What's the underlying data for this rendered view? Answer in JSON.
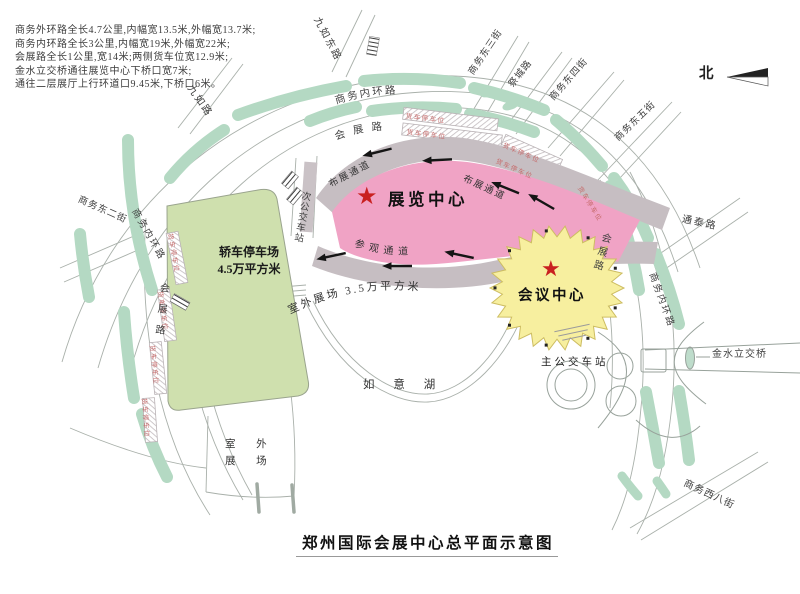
{
  "title": "郑州国际会展中心总平面示意图",
  "legend": {
    "lines": [
      "商务外环路全长4.7公里,内幅宽13.5米,外幅宽13.7米;",
      "商务内环路全长3公里,内幅宽19米,外幅宽22米;",
      "会展路全长1公里,宽14米;两侧货车位宽12.9米;",
      "金水立交桥通往展览中心下桥口宽7米;",
      "通往二层展厅上行环道口9.45米,下桥口6米。"
    ]
  },
  "compass_label": "北",
  "venues": {
    "exhibition_center": "展览中心",
    "conference_center": "会议中心",
    "car_park": {
      "line1": "轿车停车场",
      "line2": "4.5万平方米"
    },
    "outdoor_arc_label": "室外展场 3.5万平方米",
    "outdoor_sw": {
      "line1": "室 外",
      "line2": "展 场"
    },
    "lake": "如 意 湖",
    "main_bus_station": "主公交车站",
    "secondary_bus_station": "次公交车站",
    "jinshui_interchange": "金水立交桥",
    "star": "★"
  },
  "channels": {
    "setup": "布展通道",
    "visit": "参观通道",
    "truck_parking": "货车停车位"
  },
  "roads": {
    "inner_ring": "商务内环路",
    "huizhan": "会展路",
    "jiuru": "九如路",
    "jiuru_east": "九如东路",
    "e2": "商务东二街",
    "e3": "商务东三街",
    "e4": "商务东四街",
    "e5": "商务东五街",
    "jicheng": "祭城路",
    "tongtai": "通泰路",
    "w8": "商务西八街"
  },
  "colors": {
    "exhibition_pink": "#f0a3c5",
    "conference_yellow": "#f7ef9f",
    "parking_green": "#cfe0ae",
    "strip_green": "#b4d9c3",
    "channel_gray": "#c6bec2",
    "star_red": "#c92020",
    "truck_label_red": "#c66a6a"
  }
}
